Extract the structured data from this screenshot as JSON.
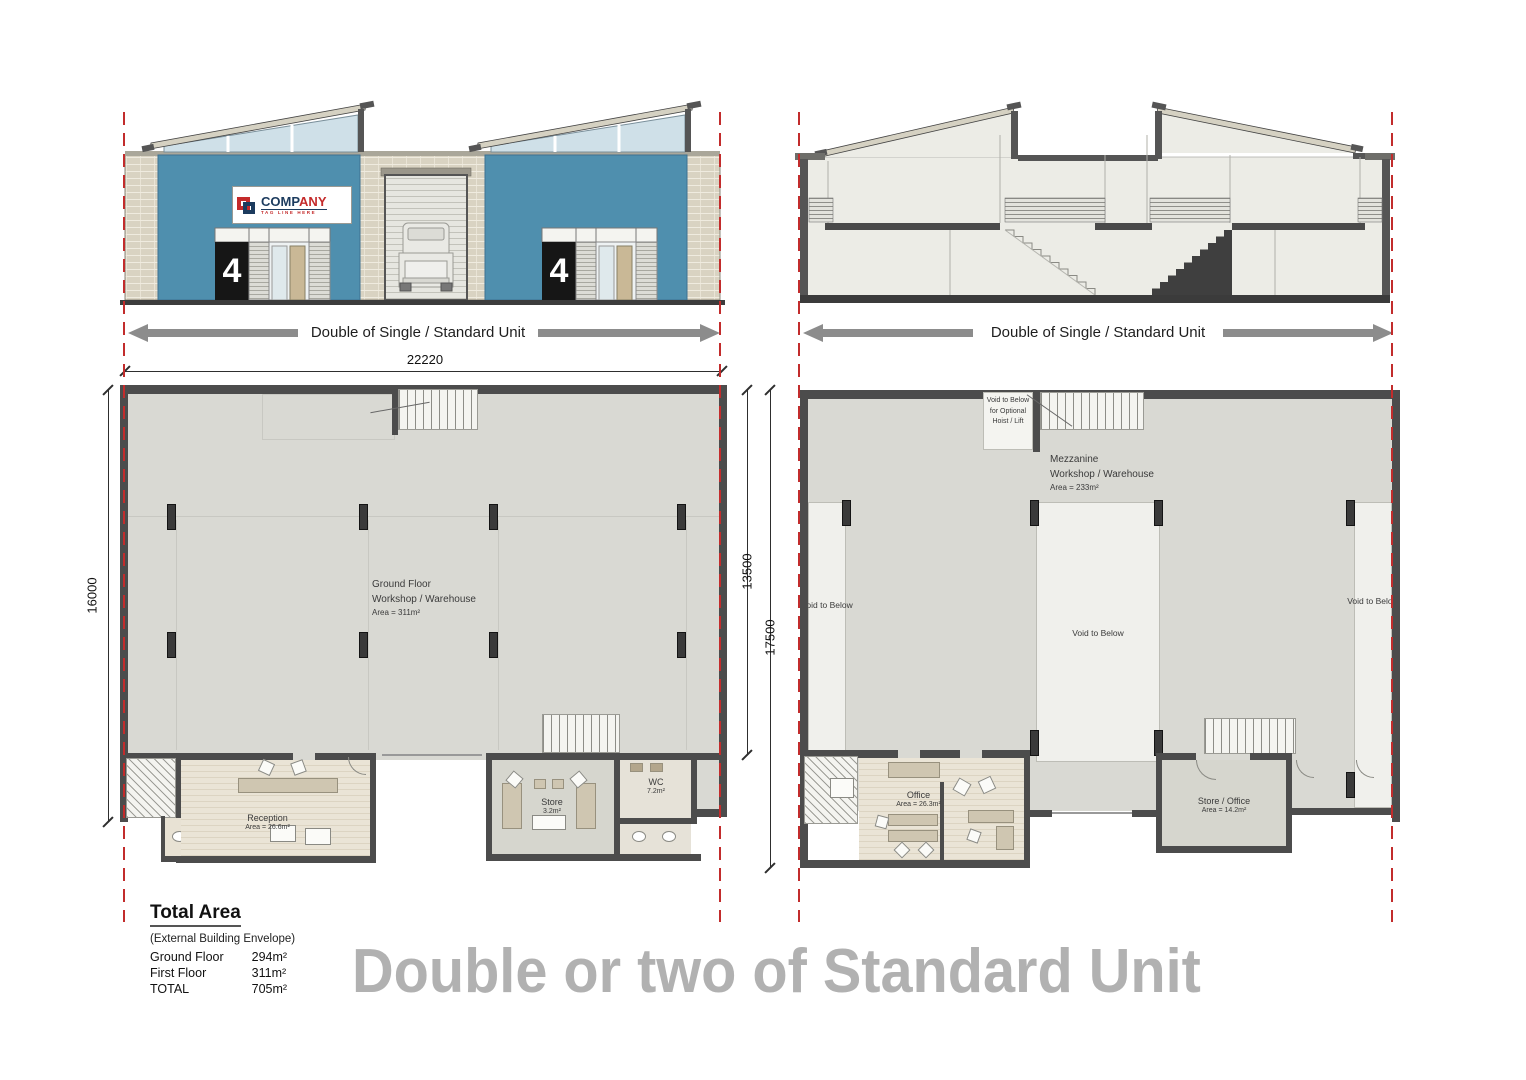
{
  "headline": "Double or two of Standard Unit",
  "front_elevation": {
    "arrow_label": "Double of Single / Standard Unit",
    "unit_number": "4",
    "sign": {
      "name_prefix": "COMP",
      "name_suffix": "ANY",
      "tagline": "TAG LINE HERE"
    }
  },
  "section_elevation": {
    "arrow_label": "Double of Single / Standard Unit"
  },
  "ground_floor": {
    "dims": {
      "width": "22220",
      "left": "16000",
      "right_inner": "13500",
      "right_outer": "17500"
    },
    "workshop": {
      "line1": "Ground Floor",
      "line2": "Workshop / Warehouse",
      "area": "Area = 311m²"
    },
    "reception": {
      "name": "Reception",
      "area": "Area = 26.6m²"
    },
    "wc_small": {
      "name": "WC",
      "area": "2.1m²"
    },
    "store": {
      "name": "Store",
      "area": "3.2m²"
    },
    "wc_large": {
      "name": "WC",
      "area": "7.2m²"
    }
  },
  "first_floor": {
    "hoist_void": "Void to Below for Optional Hoist / Lift",
    "mezzanine": {
      "line1": "Mezzanine",
      "line2": "Workshop / Warehouse",
      "area": "Area = 233m²"
    },
    "void_label": "Void to Below",
    "office": {
      "name": "Office",
      "area": "Area = 26.3m²"
    },
    "store_office": {
      "name": "Store / Office",
      "area": "Area = 14.2m²"
    }
  },
  "total_area": {
    "title": "Total Area",
    "subtitle": "(External Building Envelope)",
    "rows": [
      {
        "label": "Ground Floor",
        "value": "294m²"
      },
      {
        "label": "First Floor",
        "value": "311m²"
      },
      {
        "label": "TOTAL",
        "value": "705m²"
      }
    ]
  },
  "colors": {
    "facade_blue": "#4f8fae",
    "brick_beige": "#d9d3c2",
    "wall_dark": "#4c4c4c",
    "floor_gray": "#d9d9d3",
    "void_white": "#f0f0ec",
    "party_wall_red": "#c22c2c",
    "headline_gray": "#b1b1b1",
    "arrow_gray": "#8c8c8c",
    "sign_red": "#c42a2a",
    "sign_navy": "#1c3b5e"
  }
}
